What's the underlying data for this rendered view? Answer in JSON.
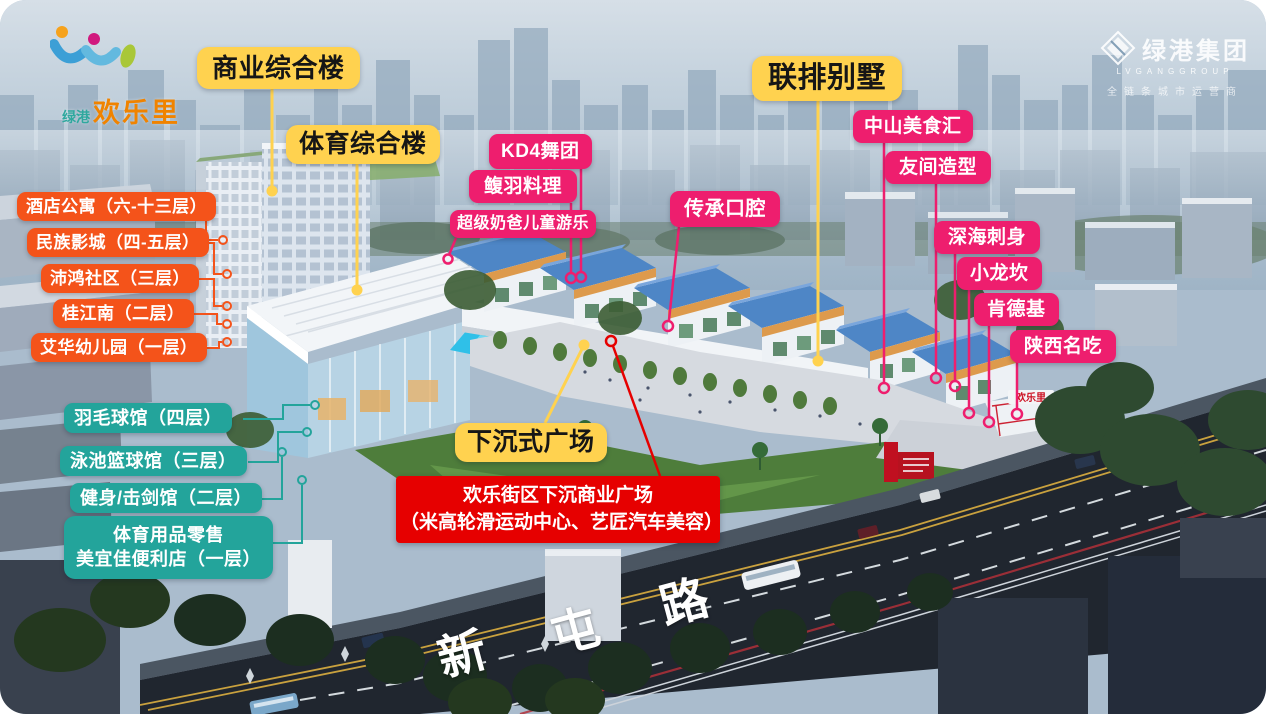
{
  "brand": {
    "site": {
      "prefix": "绿港",
      "name": "欢乐里"
    },
    "group": {
      "name": "绿港集团",
      "latin": "LVGANGGROUP",
      "tagline": "全链条城市运营商"
    }
  },
  "road": {
    "chars": [
      "新",
      "屯",
      "路"
    ]
  },
  "signs": {
    "entrance": "欢乐里"
  },
  "callouts": {
    "yellow": [
      {
        "text": "商业综合楼"
      },
      {
        "text": "体育综合楼"
      },
      {
        "text": "联排别墅"
      },
      {
        "text": "下沉式广场"
      }
    ],
    "pink": [
      {
        "text": "KD4舞团"
      },
      {
        "text": "鳆羽料理"
      },
      {
        "text": "超级奶爸儿童游乐"
      },
      {
        "text": "传承口腔"
      },
      {
        "text": "中山美食汇"
      },
      {
        "text": "友间造型"
      },
      {
        "text": "深海刺身"
      },
      {
        "text": "小龙坎"
      },
      {
        "text": "肯德基"
      },
      {
        "text": "陕西名吃"
      }
    ],
    "orange": [
      {
        "text": "酒店公寓（六-十三层）"
      },
      {
        "text": "民族影城（四-五层）"
      },
      {
        "text": "沛鸿社区（三层）"
      },
      {
        "text": "桂江南（二层）"
      },
      {
        "text": "艾华幼儿园（一层）"
      }
    ],
    "teal": [
      {
        "text": "羽毛球馆（四层）"
      },
      {
        "text": "泳池篮球馆（三层）"
      },
      {
        "text": "健身/击剑馆（二层）"
      },
      {
        "line1": "体育用品零售",
        "line2": "美宜佳便利店（一层）"
      }
    ],
    "red_note": {
      "line1": "欢乐街区下沉商业广场",
      "line2": "（米高轮滑运动中心、艺匠汽车美容）"
    }
  },
  "colors": {
    "yellow": "#FFD24F",
    "pink": "#EE1E6E",
    "orange": "#F4531A",
    "teal": "#23A49B",
    "red": "#E60000"
  }
}
